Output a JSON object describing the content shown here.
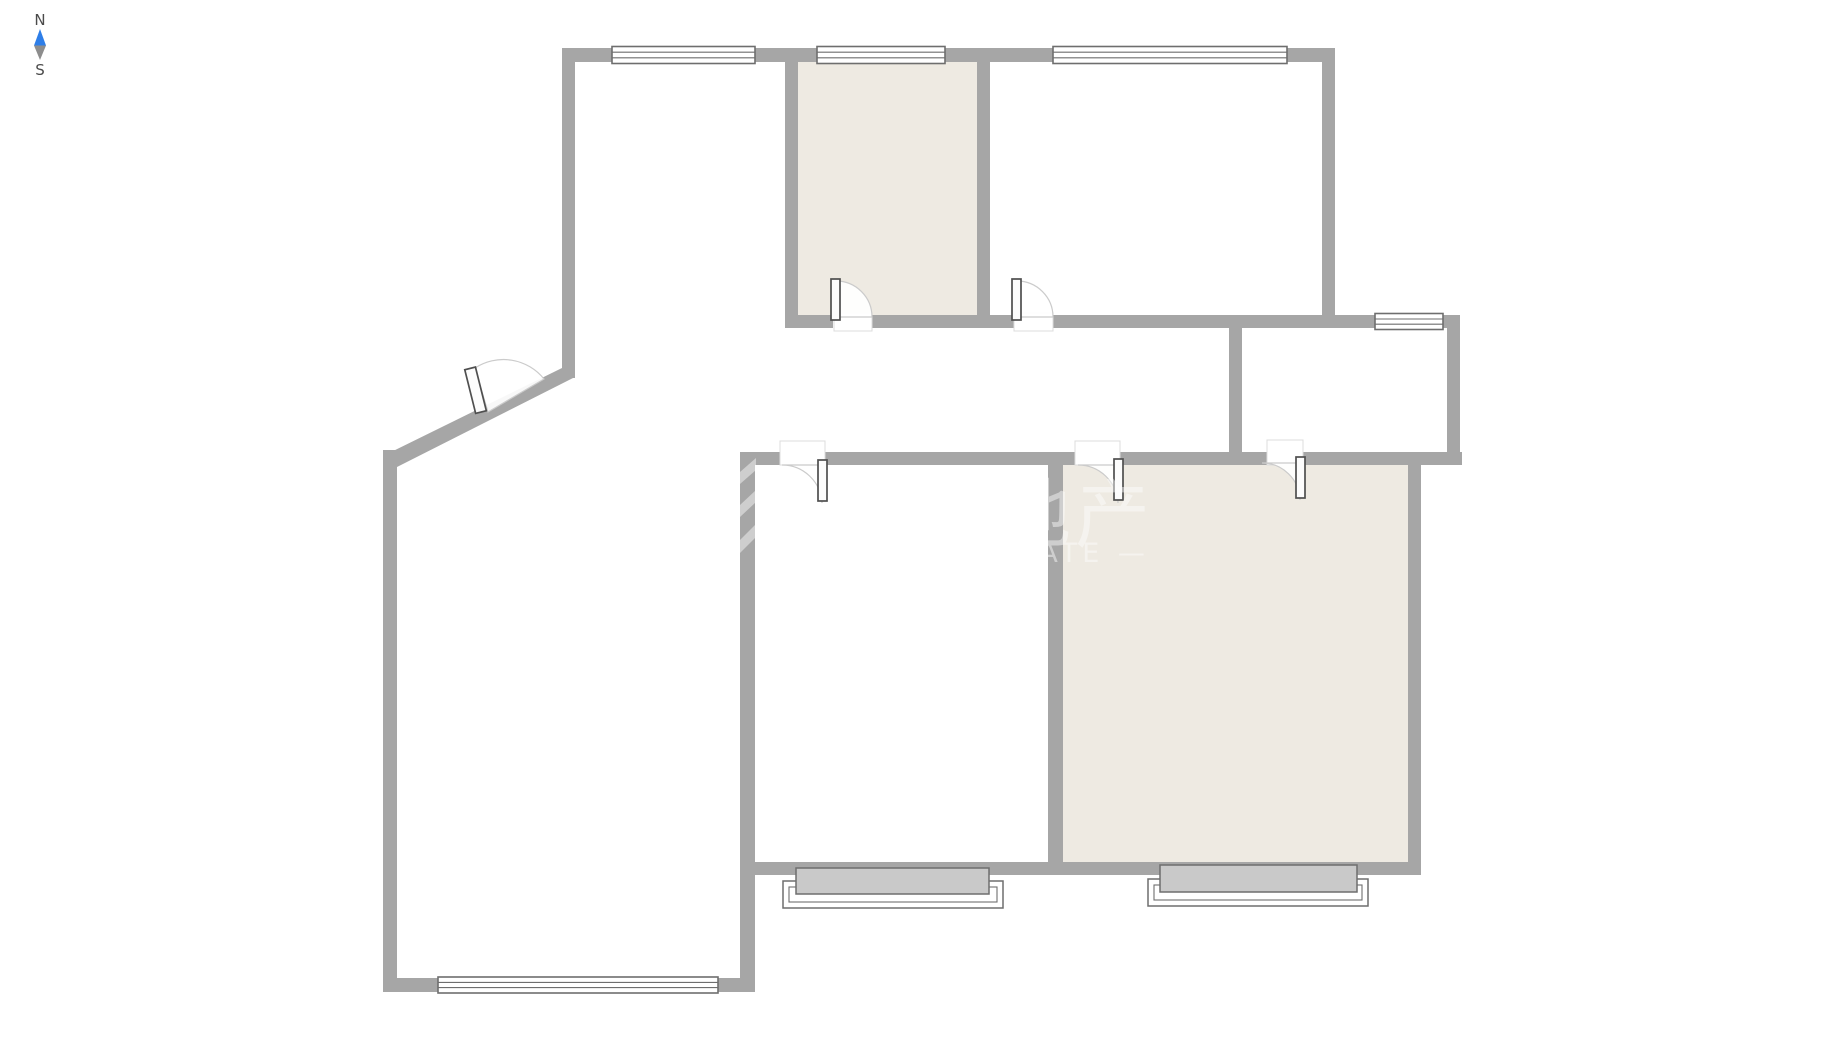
{
  "compass": {
    "north_label": "N",
    "south_label": "S"
  },
  "watermark": {
    "cjk_text": "地产",
    "latin_text": "— ESTATE —"
  },
  "colors": {
    "background": "#ffffff",
    "wall": "#a6a6a6",
    "accent-room": "#eeeae2",
    "window-frame": "#6e6e6e",
    "window-fill": "#ffffff",
    "bay-fill": "#c9c9c9",
    "bay-frame": "#6e6e6e",
    "door-frame": "#4f4f4f",
    "door-fill": "#fcfcfc",
    "door-arc": "#cbcbcb",
    "threshold-line": "#dcdcdc",
    "needle-north": "#2e7ee8",
    "needle-south": "#8d8d8d",
    "label": "#4b4b4b",
    "watermark": "#ffffff"
  }
}
